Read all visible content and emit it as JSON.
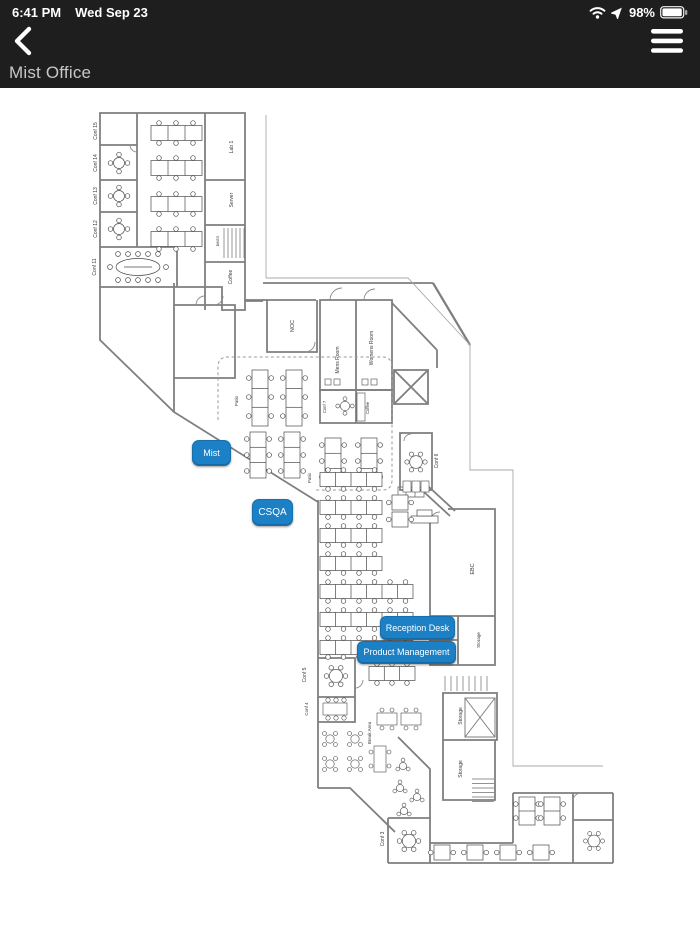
{
  "status_bar": {
    "time": "6:41 PM",
    "date": "Wed Sep 23",
    "battery_percent": "98%"
  },
  "header": {
    "title": "Mist Office"
  },
  "map": {
    "accent_color": "#1b80c5",
    "buttons": [
      {
        "id": "mist",
        "label": "Mist"
      },
      {
        "id": "csqa",
        "label": "CSQA"
      },
      {
        "id": "reception",
        "label": "Reception Desk"
      },
      {
        "id": "product_management",
        "label": "Product Management"
      }
    ],
    "rooms": {
      "conf15": "Conf 15",
      "conf14": "Conf 14",
      "conf13": "Conf 13",
      "conf12": "Conf 12",
      "conf11": "Conf 11",
      "lab1": "Lab 1",
      "server": "Server",
      "bikes": "BIKES",
      "coffee_top": "Coffee",
      "noc": "NOC",
      "mens_room": "Mens Room",
      "womens_room": "Womens Room",
      "conf7": "Conf 7",
      "coffee_mid": "Coffee",
      "patio_upper": "Patio",
      "patio_lower": "Patio",
      "conf6": "Conf 6",
      "ebc": "EBC",
      "ph2": "Ph 2",
      "ph1": "Ph 1",
      "storage_ebc": "Storage",
      "conf5": "Conf 5",
      "conf4": "Conf 4",
      "break_area": "Break Area",
      "storage_mid": "Storage",
      "storage_low": "Storage",
      "conf3": "Conf 3"
    }
  }
}
